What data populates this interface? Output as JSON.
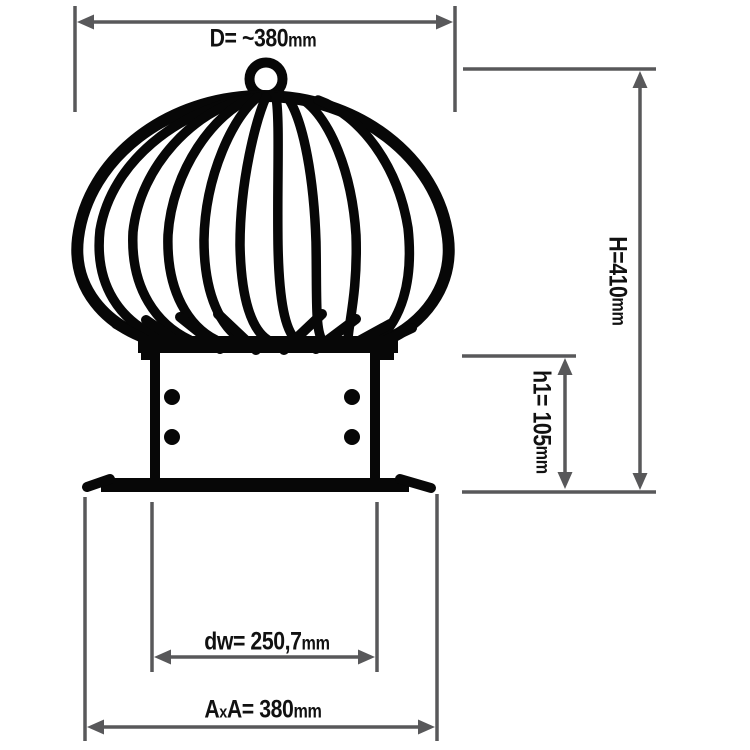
{
  "page": {
    "background": "#ffffff"
  },
  "drawing": {
    "shapes": [
      "lifting-ring-icon",
      "turbine-vane-cage-icon",
      "base-collar-icon",
      "base-box-icon",
      "rivet-icon",
      "base-flange-icon",
      "dimension-arrow-icon",
      "extension-line-icon"
    ],
    "colors": {
      "drawing_ink": "#070707",
      "dimension_lines": "#58585a",
      "label_text": "#111111"
    }
  },
  "labels": {
    "top_width": {
      "text": "D= ~380",
      "unit": "mm"
    },
    "total_height": {
      "text": "H=410",
      "unit": "mm"
    },
    "base_height": {
      "text": "h1= 105",
      "unit": "mm"
    },
    "inner_diameter": {
      "text": "dw= 250,7",
      "unit": "mm"
    },
    "outer_square": {
      "a1": "A",
      "x": "x",
      "a2": "A= 380",
      "unit": "mm"
    }
  }
}
